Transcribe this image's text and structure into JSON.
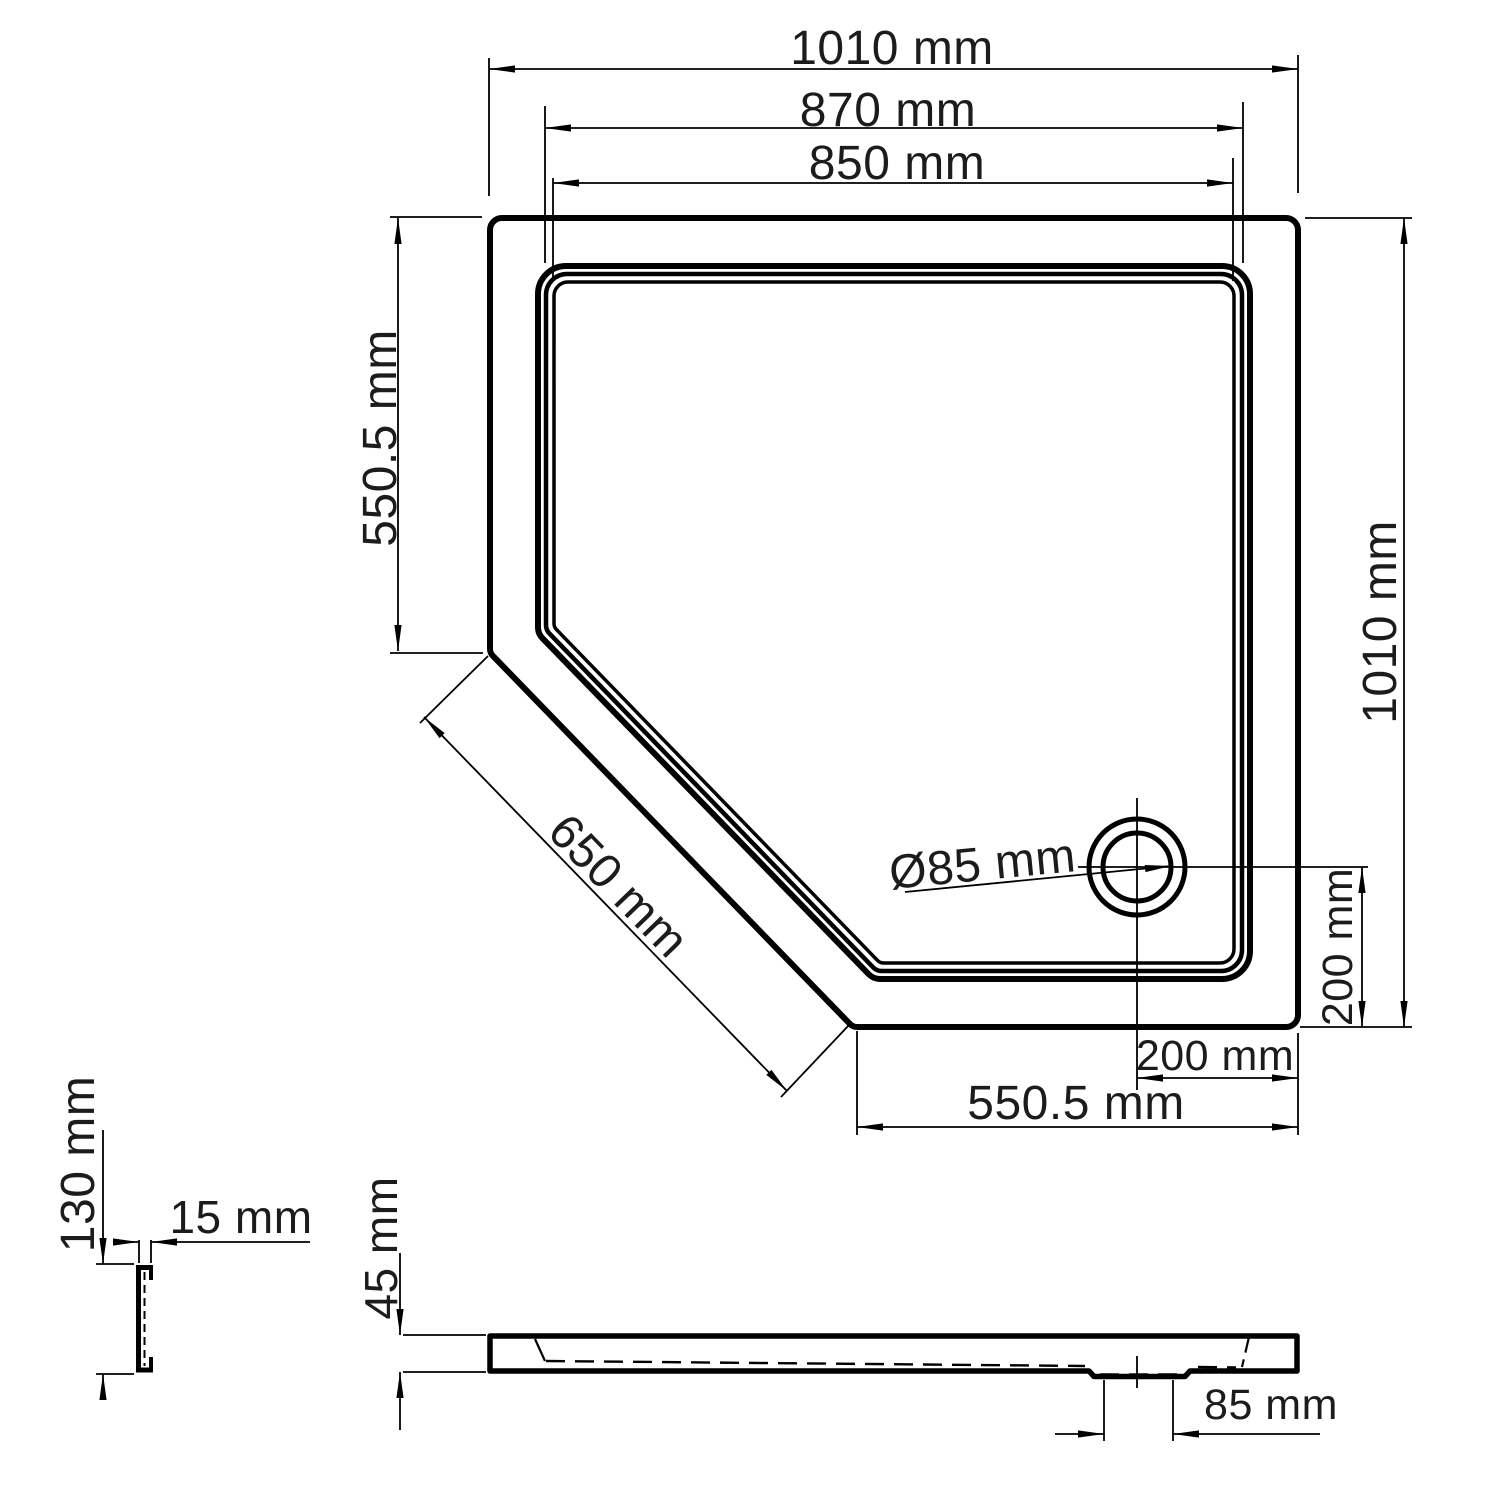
{
  "colors": {
    "line": "#000000",
    "background": "#ffffff",
    "text": "#1c1c1c"
  },
  "plan_view": {
    "overall_width": "1010 mm",
    "rim_outer_width": "870 mm",
    "rim_inner_width": "850 mm",
    "left_edge_length": "550.5 mm",
    "overall_depth": "1010 mm",
    "chamfer_length": "650 mm",
    "drain_diameter": "Ø85 mm",
    "drain_offset_vertical": "200 mm",
    "drain_offset_horizontal": "200 mm",
    "bottom_edge_length": "550.5 mm"
  },
  "edge_profile_detail": {
    "height": "130 mm",
    "depth": "15 mm"
  },
  "side_view": {
    "tray_height": "45 mm",
    "drain_recess_width": "85 mm"
  }
}
